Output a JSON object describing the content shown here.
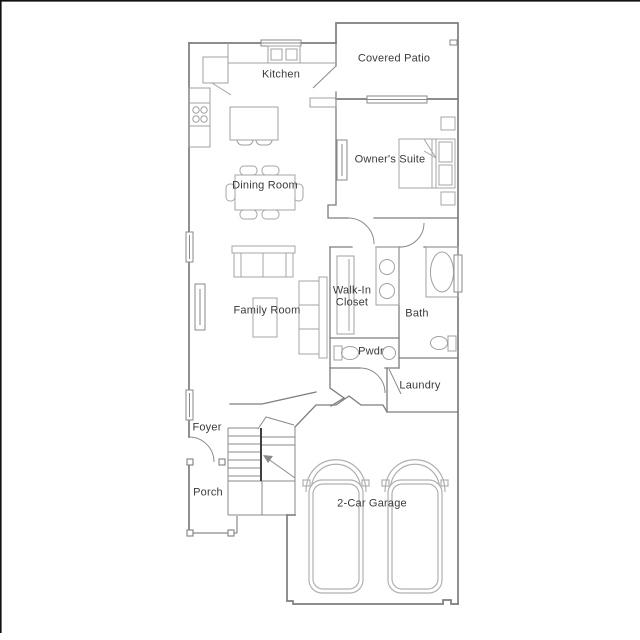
{
  "plan": {
    "type": "single-family floor plan",
    "rooms": {
      "kitchen": {
        "label": "Kitchen"
      },
      "covered_patio": {
        "label": "Covered Patio"
      },
      "owners_suite": {
        "label": "Owner's Suite"
      },
      "dining_room": {
        "label": "Dining Room"
      },
      "family_room": {
        "label": "Family Room"
      },
      "walk_in_closet": {
        "label": "Walk-In Closet"
      },
      "bath": {
        "label": "Bath"
      },
      "pwdr": {
        "label": "Pwdr"
      },
      "laundry": {
        "label": "Laundry"
      },
      "foyer": {
        "label": "Foyer"
      },
      "porch": {
        "label": "Porch"
      },
      "garage": {
        "label": "2-Car Garage"
      }
    },
    "colors": {
      "background": "#ffffff",
      "wall": "#7d7d7d",
      "furniture": "#a6a6a6",
      "stair_accent": "#3f3f3f",
      "text": "#3a3a3a",
      "edge_border": "#111111"
    }
  }
}
